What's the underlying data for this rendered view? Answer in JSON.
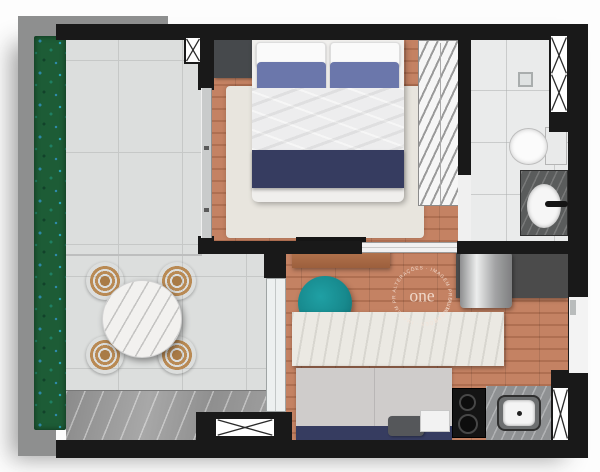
{
  "title": "studio-apartment-floor-plan",
  "watermark": {
    "brand": "one",
    "arc_text_1": "ALTERAÇÕES · IMAGEM PRELIMINAR",
    "arc_text_2": "ALTERAÇÕES · IMAGEM PRELIMINAR"
  },
  "colors": {
    "wall": "#191919",
    "wood": "#c07a59",
    "tile": "#dcdedd",
    "grout": "#c6c8c7",
    "marble": "#9c9c9c",
    "bath": "#eaebeb",
    "rug": "#e8e5de",
    "navy": "#363c60",
    "pillowBlue": "#6b77ab",
    "teal": "#17898d",
    "hedgeGreen": "#1d5c36",
    "hedgeBlue": "#2e89a8",
    "island": "#ebe9e3",
    "granite": "#5a5c5c",
    "counter": "#8f9193",
    "sofa": "#cfcccb",
    "consoleWood": "#b3744e",
    "chairWood": "#b98a54",
    "watermark": "#f6e3d7"
  }
}
